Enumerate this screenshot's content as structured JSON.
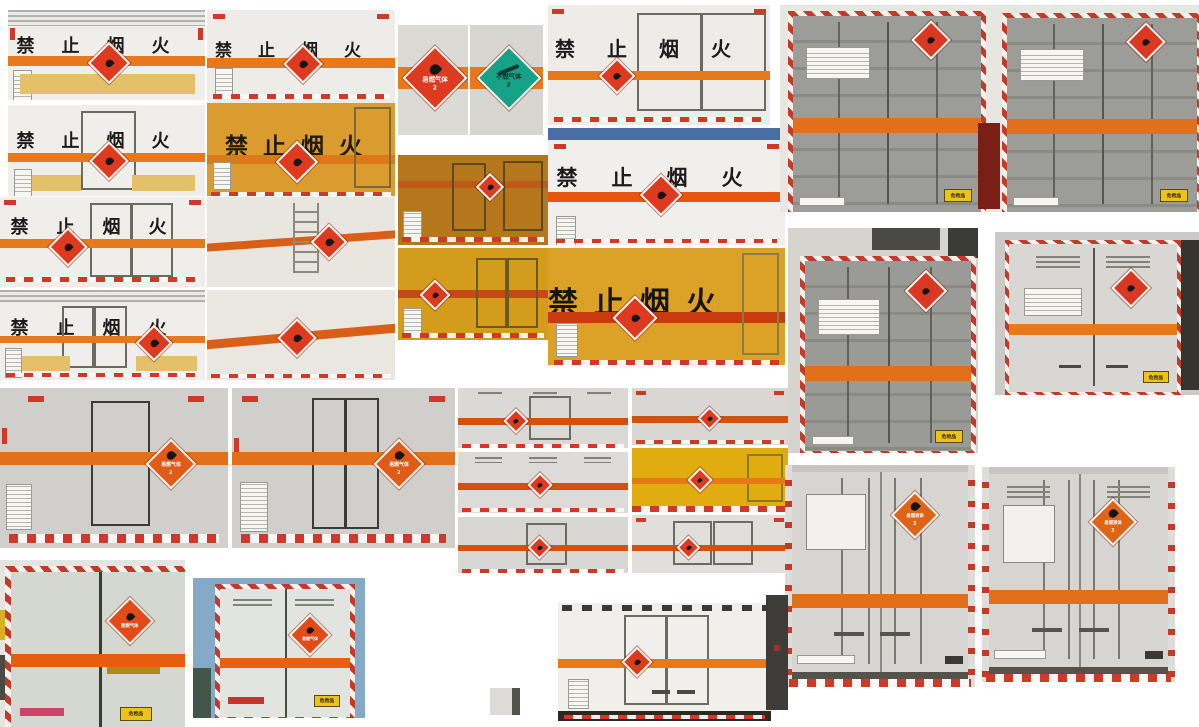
{
  "scene": {
    "type": "photo-collage",
    "description": "Collage of photos of Chinese hazardous-goods box trucks (side and rear views) with black 'no open flame' lettering, orange warning stripes, hazard-class diamond placards and red-white reflective trim",
    "background": "#ffffff"
  },
  "texts": {
    "no_fire": "禁止烟火",
    "no_fire_spaced": "禁 止 烟 火"
  },
  "placards": {
    "flammable_gas": {
      "label": "易燃气体",
      "class": "2",
      "color": "#dd3a20"
    },
    "non_flammable_gas": {
      "label": "不燃气体",
      "class": "2",
      "color": "#17a287"
    },
    "flammable_liquid": {
      "label": "易燃液体",
      "class": "3",
      "color": "#e06418"
    }
  },
  "labels": {
    "danger_goods": "危险品"
  },
  "colors": {
    "warning_stripe_orange": "#e8781c",
    "bright_stripe_orange": "#e8550f",
    "placard_red": "#dd3a20",
    "placard_green": "#17a287",
    "box_yellow": "#dca228",
    "box_amber": "#b5761c",
    "container_gray": "#9c9c98",
    "reflective_red": "#cf3a28",
    "cab_blue": "#4a6ea3"
  }
}
